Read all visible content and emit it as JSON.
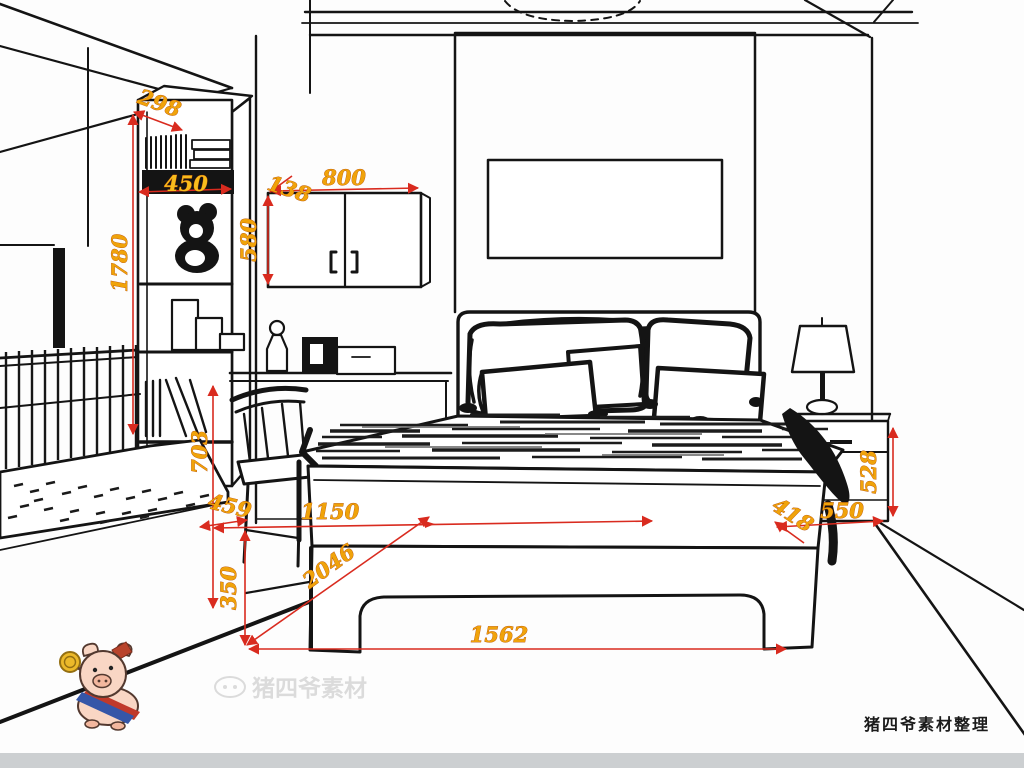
{
  "title": "bedroom furniture dimension drawing",
  "dims": {
    "bookshelf_top": "298",
    "bookshelf_shelf_width": "450",
    "bookshelf_height": "1780",
    "cabinet_gap": "138",
    "cabinet_width": "800",
    "cabinet_height": "580",
    "desk_height": "703",
    "chair_clearance": "459",
    "bed_front_offset": "1150",
    "bed_diagonal": "2046",
    "bed_base_height": "350",
    "bed_footboard_width": "1562",
    "bed_corner_offset": "418",
    "nightstand_width": "550",
    "nightstand_height": "528"
  },
  "watermark_text": "猪四爷素材",
  "credit": "猪四爷素材整理"
}
